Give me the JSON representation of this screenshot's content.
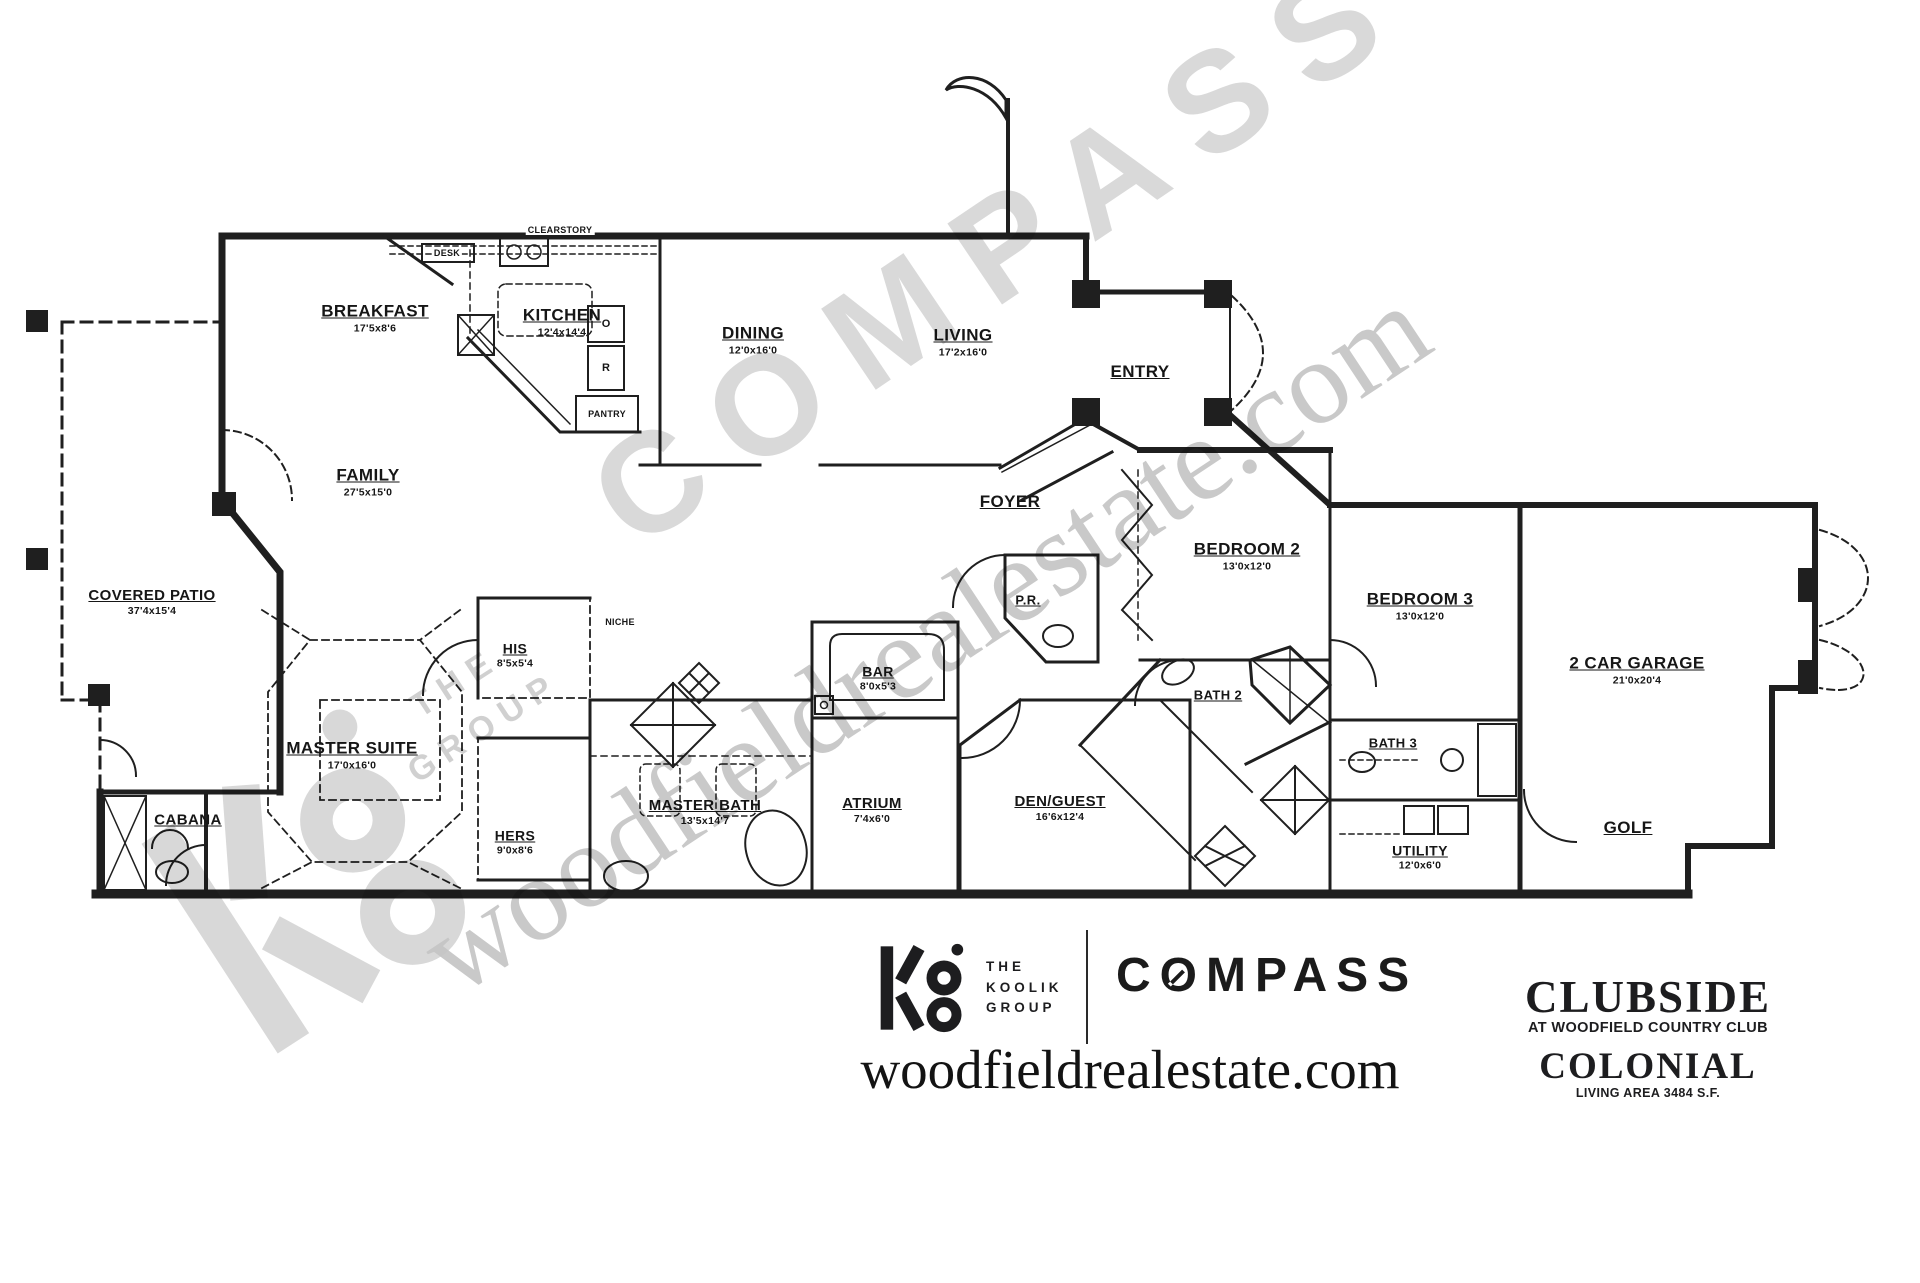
{
  "rooms": [
    {
      "label": "BREAKFAST",
      "dim": "17'5x8'6"
    },
    {
      "label": "KITCHEN",
      "dim": "12'4x14'4"
    },
    {
      "label": "DINING",
      "dim": "12'0x16'0"
    },
    {
      "label": "LIVING",
      "dim": "17'2x16'0"
    },
    {
      "label": "ENTRY",
      "dim": ""
    },
    {
      "label": "FAMILY",
      "dim": "27'5x15'0"
    },
    {
      "label": "FOYER",
      "dim": ""
    },
    {
      "label": "COVERED PATIO",
      "dim": "37'4x15'4"
    },
    {
      "label": "MASTER SUITE",
      "dim": "17'0x16'0"
    },
    {
      "label": "HIS",
      "dim": "8'5x5'4"
    },
    {
      "label": "HERS",
      "dim": "9'0x8'6"
    },
    {
      "label": "MASTER BATH",
      "dim": "13'5x14'7"
    },
    {
      "label": "BAR",
      "dim": "8'0x5'3"
    },
    {
      "label": "ATRIUM",
      "dim": "7'4x6'0"
    },
    {
      "label": "DEN/GUEST",
      "dim": "16'6x12'4"
    },
    {
      "label": "P.R.",
      "dim": ""
    },
    {
      "label": "BEDROOM 2",
      "dim": "13'0x12'0"
    },
    {
      "label": "BEDROOM 3",
      "dim": "13'0x12'0"
    },
    {
      "label": "BATH 2",
      "dim": ""
    },
    {
      "label": "BATH 3",
      "dim": ""
    },
    {
      "label": "UTILITY",
      "dim": "12'0x6'0"
    },
    {
      "label": "2 CAR GARAGE",
      "dim": "21'0x20'4"
    },
    {
      "label": "GOLF",
      "dim": ""
    },
    {
      "label": "CABANA",
      "dim": ""
    }
  ],
  "annotations": {
    "clearstory": "CLEARSTORY",
    "desk": "DESK",
    "pantry": "PANTRY",
    "niche": "NICHE",
    "oven": "O",
    "range": "R"
  },
  "watermarks": {
    "compass": "COMPASS",
    "website": "woodfieldrealestate.com",
    "koolik_line1": "THE",
    "koolik_line2": "GROUP"
  },
  "branding": {
    "koolik_line1": "THE",
    "koolik_line2": "KOOLIK",
    "koolik_line3": "GROUP",
    "compass_wordmark": "COMPASS",
    "website": "woodfieldrealestate.com",
    "plan_name": "CLUBSIDE",
    "plan_subtitle": "AT WOODFIELD COUNTRY CLUB",
    "model_name": "COLONIAL",
    "living_area": "LIVING AREA 3484 S.F."
  }
}
